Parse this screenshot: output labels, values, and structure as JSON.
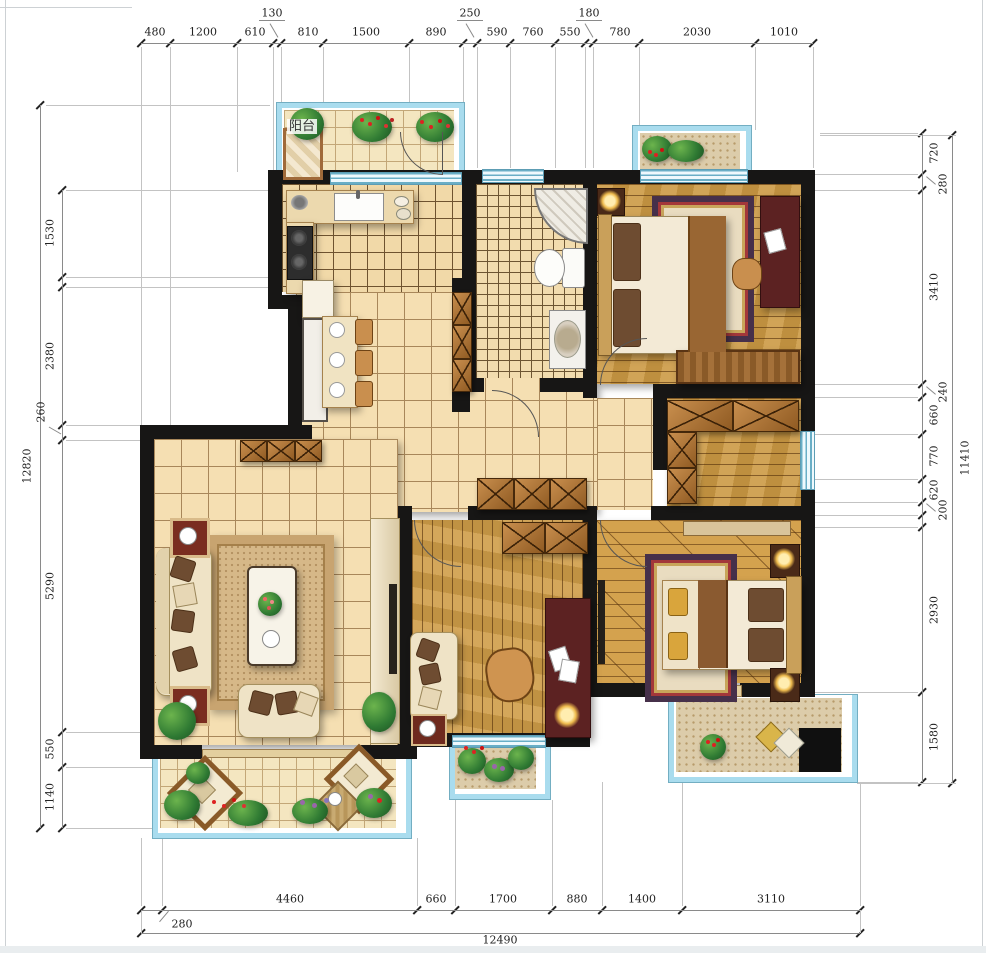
{
  "labels": {
    "balcony": "阳台"
  },
  "dims": {
    "top": [
      "480",
      "1200",
      "610",
      "810",
      "1500",
      "890",
      "590",
      "760",
      "550",
      "780",
      "2030",
      "1010"
    ],
    "top_raised": [
      "130",
      "250",
      "180"
    ],
    "left": [
      "1530",
      "2380",
      "5290",
      "550",
      "1140"
    ],
    "left_raised": [
      "260"
    ],
    "left_total": "12820",
    "right": [
      "720",
      "3410",
      "660",
      "770",
      "620",
      "2930",
      "1580"
    ],
    "right_raised": [
      "280",
      "240",
      "200"
    ],
    "right_total": "11410",
    "bottom": [
      "4460",
      "660",
      "1700",
      "880",
      "1400",
      "3110"
    ],
    "bottom_raised": [
      "280"
    ],
    "bottom_total": "12490"
  },
  "colors": {
    "wall": "#171615",
    "glass": "#a9dcee",
    "tile": "#f5dfb2",
    "wood": "#cc9a44",
    "accent_desk": "#5c2222"
  }
}
